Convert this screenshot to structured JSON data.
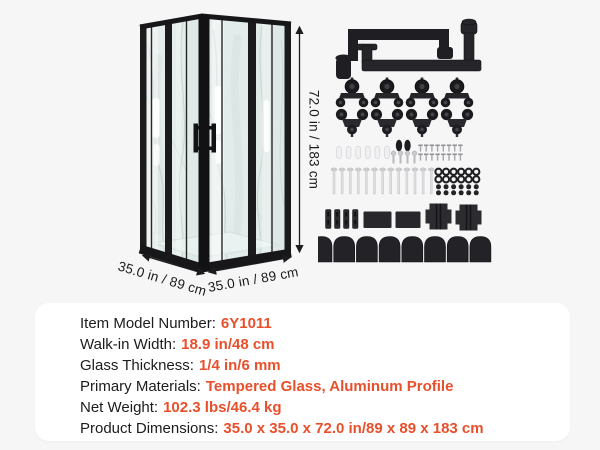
{
  "canvas": {
    "background": "#f6f6f7",
    "accent_color": "#E8502C",
    "text_color": "#1B1B1D"
  },
  "enclosure": {
    "description": "corner-entry framed shower enclosure with marble walls and sliding glass doors",
    "dimensions": {
      "height": "72.0 in / 183 cm",
      "width_left": "35.0 in / 89 cm",
      "width_right": "35.0 in / 89 cm"
    }
  },
  "hardware": {
    "parts": [
      {
        "name": "door-handles",
        "count": 2
      },
      {
        "name": "top-rollers",
        "count": 4
      },
      {
        "name": "bottom-rollers",
        "count": 4
      },
      {
        "name": "wall-anchors",
        "count": 6
      },
      {
        "name": "rubber-plugs",
        "count": 2
      },
      {
        "name": "short-screws",
        "count": 4
      },
      {
        "name": "small-screws",
        "count": 16
      },
      {
        "name": "long-screws",
        "count": 13
      },
      {
        "name": "o-rings",
        "count": 12
      },
      {
        "name": "screw-cap-dots",
        "count": 12
      },
      {
        "name": "profile-strips",
        "count": 4
      },
      {
        "name": "mounting-plates",
        "count": 2
      },
      {
        "name": "glass-clamps",
        "count": 2
      },
      {
        "name": "dome-caps",
        "count": 8
      }
    ]
  },
  "specs": {
    "rows": [
      {
        "label": "Item Model Number:",
        "value": "6Y1011"
      },
      {
        "label": "Walk-in Width:",
        "value": "18.9 in/48 cm"
      },
      {
        "label": "Glass Thickness:",
        "value": "1/4 in/6 mm"
      },
      {
        "label": "Primary Materials:",
        "value": "Tempered Glass, Aluminum Profile"
      },
      {
        "label": "Net Weight:",
        "value": "102.3 lbs/46.4 kg"
      },
      {
        "label": "Product Dimensions:",
        "value": "35.0 x 35.0 x 72.0 in/89 x 89 x 183 cm"
      }
    ]
  }
}
